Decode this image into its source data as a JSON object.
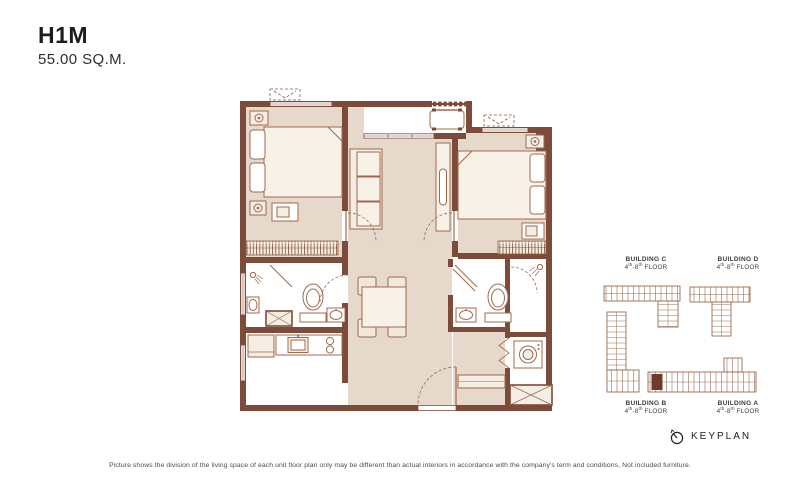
{
  "unit": {
    "code": "H1M",
    "area": "55.00 SQ.M."
  },
  "keyplan": {
    "label": "KEYPLAN",
    "icon": "compass-north-icon",
    "highlight_color": "#6e3b2b",
    "buildings": [
      {
        "name": "BUILDING C",
        "f1": "4",
        "s1": "th",
        "f2": "-8",
        "s2": "th",
        "f3": " FLOOR",
        "position": "top-left"
      },
      {
        "name": "BUILDING D",
        "f1": "4",
        "s1": "th",
        "f2": "-8",
        "s2": "th",
        "f3": " FLOOR",
        "position": "top-right"
      },
      {
        "name": "BUILDING B",
        "f1": "4",
        "s1": "th",
        "f2": "-8",
        "s2": "th",
        "f3": " FLOOR",
        "position": "bottom-left"
      },
      {
        "name": "BUILDING A",
        "f1": "4",
        "s1": "th",
        "f2": "-8",
        "s2": "th",
        "f3": " FLOOR",
        "position": "bottom-right"
      }
    ]
  },
  "footer": {
    "disclaimer": "Picture shows the division of the living space of each unit floor plan only may be different than actual interiors in accordance with the company's term and conditions, Not included furniture."
  },
  "colors": {
    "wall_brown": "#7d4b39",
    "floor_tan": "#e6d8cb",
    "furniture_line": "#a0694e",
    "furniture_fill": "#f4ede3",
    "closet_hatch": "#8a5a42",
    "keyplan_line": "#9b6b52",
    "keyplan_highlight": "#6e3b2b",
    "text_dark": "#1d1d1d"
  }
}
